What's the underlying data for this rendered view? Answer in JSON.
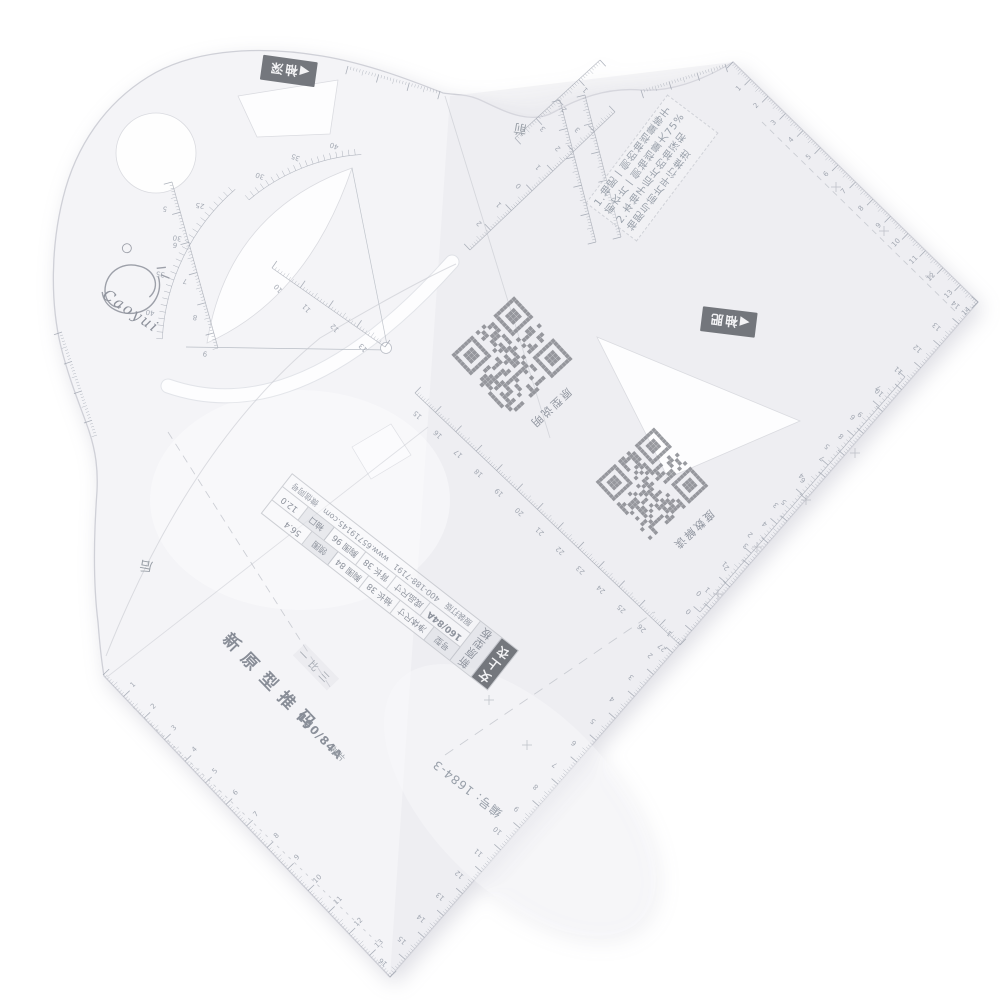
{
  "photo": {
    "background": "#ffffff",
    "sheet_fill": "#f4f4f7",
    "edge_color": "#cfd0d7",
    "print_color": "#9aa0ab",
    "dark_label_bg": "#686b72",
    "qr_color": "#87898f"
  },
  "brand": {
    "name": "Caoyui",
    "registered": "®"
  },
  "badges": {
    "sleeve_depth": {
      "arrow": "◀",
      "label": "袖深"
    },
    "sleeve_width": {
      "arrow": "◀",
      "label": "袖肥"
    }
  },
  "markers": {
    "front": "前",
    "back": "后"
  },
  "instructions": {
    "lines": [
      "1.袖肥一侧的袖裆量等于",
      "前衣片一侧袖裆量大75%",
      "2.本袖子后片的袖深和",
      "袖肥与前片平行推进"
    ]
  },
  "qr_captions": {
    "q1": "原型说明",
    "q2": "度数解读"
  },
  "part_caption": {
    "chars": [
      "新",
      "原",
      "型",
      "推",
      "码"
    ],
    "ratio": "一比三",
    "size": "160/84A",
    "piece": "袖片"
  },
  "serial": "编号: 1684-3",
  "table": {
    "product": "女上衣",
    "series": "新原型板",
    "rows": [
      [
        "号型",
        "净体尺寸",
        "袖长 38",
        "胸围 84",
        "领围",
        "56.4"
      ],
      [
        "160/84A",
        "成品尺寸",
        "背长 38",
        "胸围 96",
        "袖口",
        "12.0"
      ]
    ],
    "footer": [
      "服装打版",
      "400-188-7191",
      "www.65719145.com",
      "微信同号"
    ]
  },
  "rulers": [
    {
      "name": "edge-top-right",
      "x1": 733,
      "y1": 62,
      "x2": 978,
      "y2": 302,
      "units": 14,
      "side": -1,
      "loff": 15,
      "lrot": -46,
      "seq": {
        "n": 14,
        "t0": 1,
        "dt": 1,
        "u0": 1,
        "du": 1
      }
    },
    {
      "name": "edge-bottom-right",
      "x1": 978,
      "y1": 302,
      "x2": 390,
      "y2": 977,
      "units": 30.8,
      "side": -1,
      "loff": 15,
      "lrot": 221,
      "seq": {
        "n": 15,
        "t0": 14,
        "dt": -1,
        "u0": 0.5,
        "du": 1
      },
      "seq2": {
        "n": 16,
        "t0": 1,
        "dt": 1,
        "u0": 15.5,
        "du": 1
      }
    },
    {
      "name": "edge-bottom-left",
      "x1": 103,
      "y1": 675,
      "x2": 390,
      "y2": 977,
      "units": 14,
      "side": 1,
      "loff": 15,
      "lrot": -44,
      "seq": {
        "n": 13,
        "t0": 1,
        "dt": 1,
        "u0": 1,
        "du": 1
      }
    },
    {
      "name": "inner-right-scale",
      "x1": 700,
      "y1": 612,
      "x2": 905,
      "y2": 377,
      "units": 8,
      "side": 1,
      "loff": 13,
      "lrot": 221,
      "line": 1,
      "seq": {
        "n": 8,
        "t0": 0,
        "dt": 1,
        "u0": 0.4,
        "du": 1
      }
    },
    {
      "name": "inner-long-scale",
      "x1": 415,
      "y1": 393,
      "x2": 680,
      "y2": 645,
      "units": 13,
      "side": 1,
      "loff": -12,
      "lrot": 223,
      "line": 1,
      "seq": {
        "n": 13,
        "t0": 15,
        "dt": 1,
        "u0": 0.6,
        "du": 1
      }
    },
    {
      "name": "front-balance-scale",
      "x1": 470,
      "y1": 250,
      "x2": 615,
      "y2": 112,
      "units": 7,
      "side": 1,
      "loff": 13,
      "lrot": 226,
      "line": 1,
      "labels": [
        {
          "u": 0.95,
          "t": "2"
        },
        {
          "u": 1.9,
          "t": "1"
        },
        {
          "u": 2.85,
          "t": "0"
        },
        {
          "u": 3.8,
          "t": "1"
        },
        {
          "u": 4.75,
          "t": "2"
        },
        {
          "u": 5.7,
          "t": "3"
        }
      ]
    },
    {
      "name": "notch-scale",
      "x1": 600,
      "y1": 60,
      "x2": 515,
      "y2": 138,
      "units": 4,
      "side": 1,
      "loff": 12,
      "lrot": 223,
      "line": 1,
      "labels": [
        {
          "u": 1,
          "t": "1"
        },
        {
          "u": 2,
          "t": "2"
        },
        {
          "u": 3,
          "t": "3"
        }
      ]
    },
    {
      "name": "curve-left-scale",
      "x1": 172,
      "y1": 182,
      "x2": 218,
      "y2": 348,
      "units": 5.5,
      "side": -1,
      "loff": 13,
      "lrot": 190,
      "line": 1,
      "seq": {
        "n": 5,
        "t0": 5,
        "dt": 1,
        "u0": 0.7,
        "du": 1.2
      }
    },
    {
      "name": "triangle-hyp-scale",
      "x1": 272,
      "y1": 268,
      "x2": 385,
      "y2": 347,
      "units": 4,
      "side": 1,
      "loff": -11,
      "lrot": 226,
      "line": 1,
      "seq": {
        "n": 4,
        "t0": 10,
        "dt": 1,
        "u0": 0.5,
        "du": 1
      }
    },
    {
      "name": "head-left-fringe",
      "x1": 62,
      "y1": 332,
      "x2": 97,
      "y2": 435,
      "units": 3.5,
      "side": -1,
      "loff": 0,
      "lrot": 0
    },
    {
      "name": "head-top-fringe",
      "x1": 348,
      "y1": 66,
      "x2": 440,
      "y2": 91,
      "units": 3,
      "side": -1,
      "loff": 0,
      "lrot": 0
    },
    {
      "name": "top-notch-fringe",
      "x1": 641,
      "y1": 90,
      "x2": 725,
      "y2": 64,
      "units": 3,
      "side": -1,
      "loff": 0,
      "lrot": 0
    },
    {
      "name": "vertical-strip-1",
      "x1": 560,
      "y1": 100,
      "x2": 596,
      "y2": 242,
      "units": 5,
      "side": -1,
      "loff": 0,
      "lrot": 0,
      "line": 1
    },
    {
      "name": "vertical-strip-2",
      "x1": 585,
      "y1": 95,
      "x2": 621,
      "y2": 237,
      "units": 5,
      "side": -1,
      "loff": 0,
      "lrot": 0,
      "line": 1
    }
  ],
  "arcs": [
    {
      "name": "protractor-lower-arc",
      "cx": 375,
      "cy": 350,
      "r": 213,
      "a1": 183,
      "a2": 229,
      "step": 1.8,
      "len": 6,
      "loff": 15,
      "lrot": 190,
      "labels": [
        {
          "a": 190,
          "t": "40"
        },
        {
          "a": 200,
          "t": "35"
        },
        {
          "a": 210,
          "t": "30"
        },
        {
          "a": 220,
          "t": "25"
        }
      ]
    },
    {
      "name": "protractor-upper-arc",
      "cx": 375,
      "cy": 350,
      "r": 196,
      "a1": 230,
      "a2": 266,
      "step": 1.8,
      "len": 6,
      "loff": 14,
      "lrot": 200,
      "labels": [
        {
          "a": 237,
          "t": "30"
        },
        {
          "a": 248,
          "t": "35"
        },
        {
          "a": 259,
          "t": "40"
        }
      ]
    }
  ],
  "qr": [
    {
      "name": "qr-pattern-notes",
      "cx": 512,
      "cy": 357,
      "size": 86,
      "rot": 47,
      "seed": 7
    },
    {
      "name": "qr-degree-notes",
      "cx": 652,
      "cy": 484,
      "size": 80,
      "rot": 47,
      "seed": 13
    }
  ],
  "crosses": [
    [
      757,
      547
    ],
    [
      806,
      500
    ],
    [
      855,
      453
    ],
    [
      718,
      594
    ],
    [
      836,
      187
    ],
    [
      884,
      231
    ],
    [
      930,
      276
    ],
    [
      489,
      700
    ],
    [
      527,
      745
    ]
  ],
  "dashes": [
    [
      168,
      432,
      332,
      690,
      "8 6"
    ],
    [
      762,
      122,
      958,
      314,
      "6 5"
    ],
    [
      133,
      707,
      383,
      948,
      "3 5"
    ],
    [
      445,
      755,
      655,
      612,
      "10 8"
    ]
  ]
}
